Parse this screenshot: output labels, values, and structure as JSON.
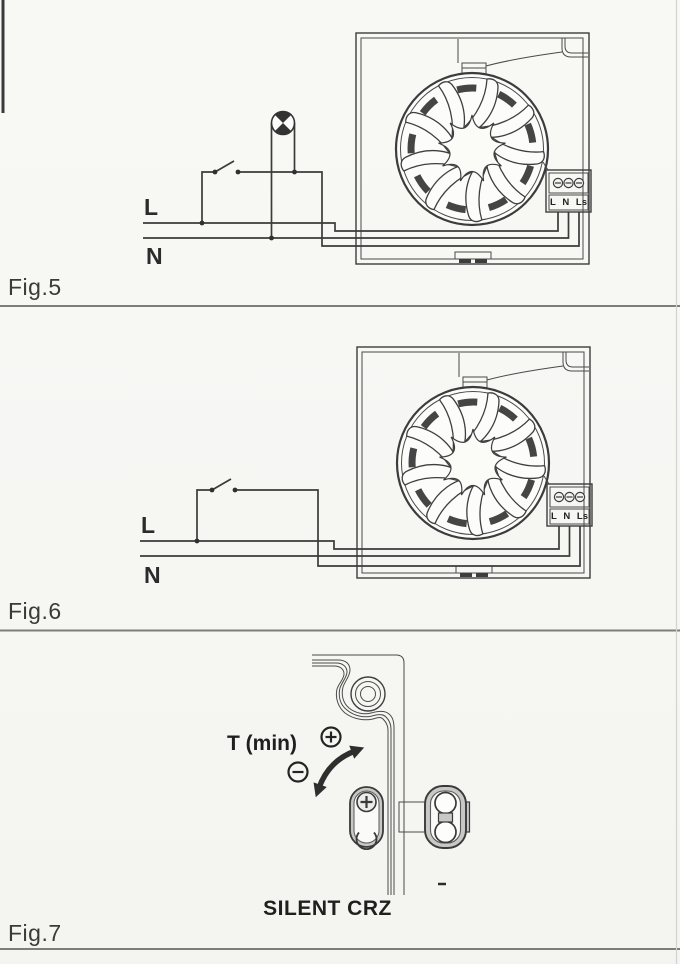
{
  "page": {
    "paper_color": "#f7f7f4",
    "ink_color": "#3d3d3d",
    "component_gray": "#c8c8c6",
    "divider_color": "#7d7d7a"
  },
  "fig5": {
    "label": "Fig.5",
    "live_label": "L",
    "neutral_label": "N",
    "terminal_labels": [
      "L",
      "N",
      "Ls"
    ]
  },
  "fig6": {
    "label": "Fig.6",
    "live_label": "L",
    "neutral_label": "N",
    "terminal_labels": [
      "L",
      "N",
      "Ls"
    ]
  },
  "fig7": {
    "label": "Fig.7",
    "adjust_label": "T (min)",
    "model_label": "SILENT CRZ"
  }
}
